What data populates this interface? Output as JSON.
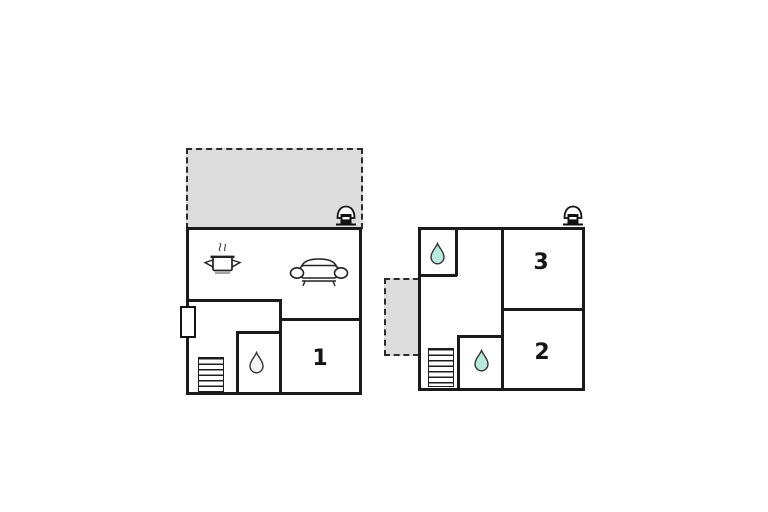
{
  "colors": {
    "background": "#ffffff",
    "wall": "#1b1b1b",
    "terrace": "#dcdcdc",
    "drop": "#b9e9da"
  },
  "floorplans": {
    "left": {
      "room_label": "1",
      "icons": [
        "fireplace-icon",
        "cooking-pot-icon",
        "sofa-icon",
        "water-drop-icon",
        "stairs-icon",
        "door",
        "terrace-dashed-area"
      ]
    },
    "right": {
      "room_label_top": "3",
      "room_label_bottom": "2",
      "icons": [
        "fireplace-icon",
        "water-drop-icon",
        "water-drop-icon",
        "stairs-icon",
        "terrace-dashed-area"
      ]
    }
  }
}
